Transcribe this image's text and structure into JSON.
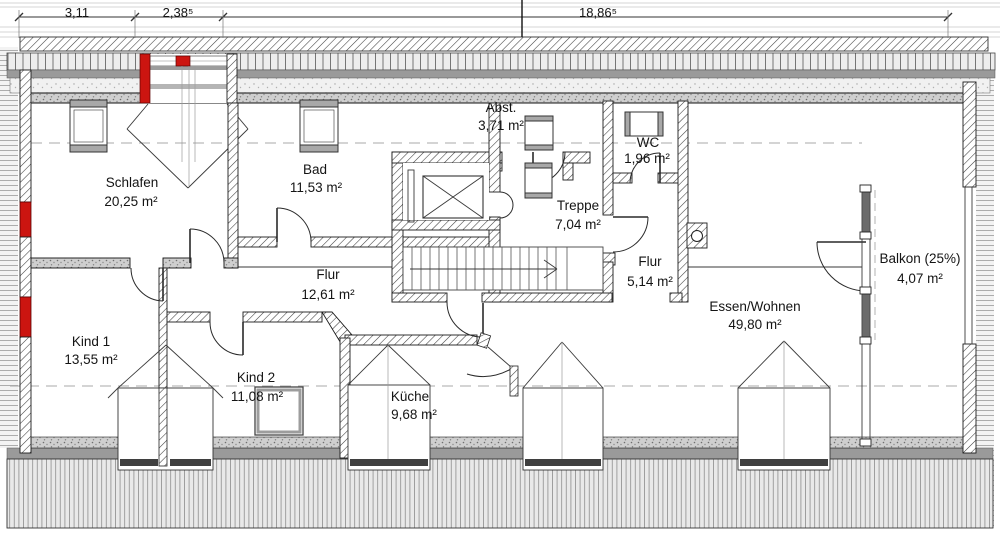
{
  "dimensions": [
    {
      "label": "3,11"
    },
    {
      "label": "2,38⁵"
    },
    {
      "label": "18,86⁵"
    }
  ],
  "rooms": [
    {
      "name": "Schlafen",
      "area": "20,25 m²"
    },
    {
      "name": "Bad",
      "area": "11,53 m²"
    },
    {
      "name": "Abst.",
      "area": "3,71 m²"
    },
    {
      "name": "WC",
      "area": "1,96 m²"
    },
    {
      "name": "Treppe",
      "area": "7,04 m²"
    },
    {
      "name": "Flur",
      "area": "12,61 m²"
    },
    {
      "name": "Flur",
      "area": "5,14 m²"
    },
    {
      "name": "Essen/Wohnen",
      "area": "49,80 m²"
    },
    {
      "name": "Balkon (25%)",
      "area": "4,07 m²"
    },
    {
      "name": "Kind 1",
      "area": "13,55 m²"
    },
    {
      "name": "Kind 2",
      "area": "11,08 m²"
    },
    {
      "name": "Küche",
      "area": "9,68 m²"
    }
  ],
  "colors": {
    "dimension_highlight": "#cc1f10",
    "wall_red": "#cc1510",
    "band_gray": "#9a9a9a"
  }
}
